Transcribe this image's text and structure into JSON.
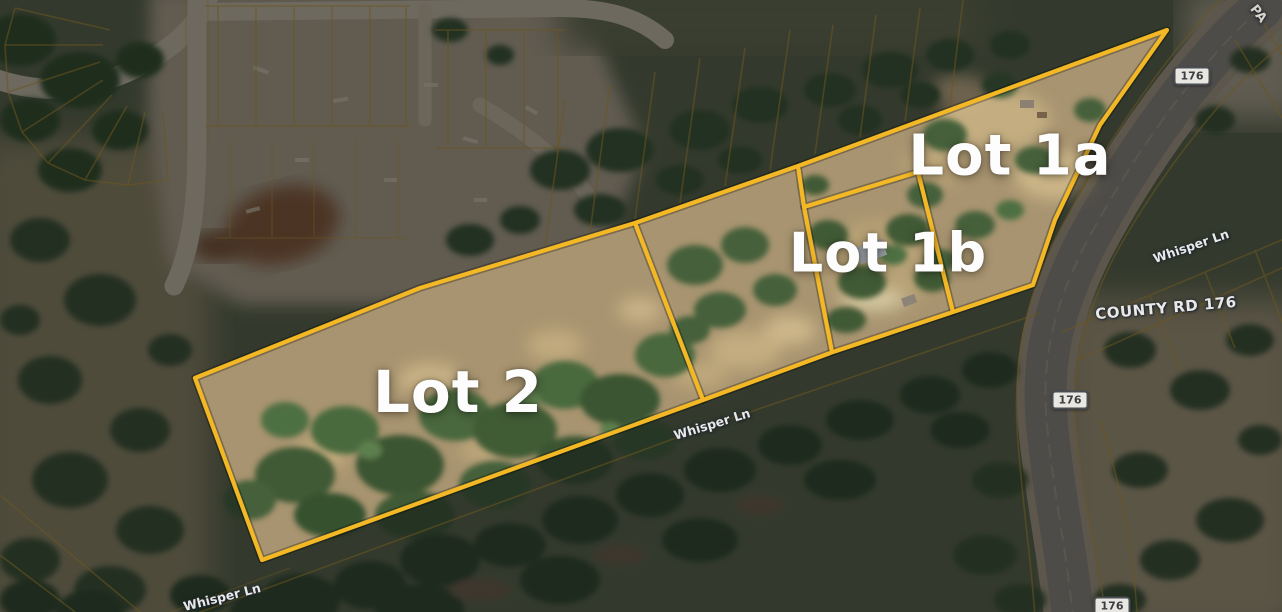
{
  "map": {
    "description": "Aerial parcel map with highlighted lots for sale",
    "lots": [
      {
        "id": "lot-1a",
        "label": "Lot 1a"
      },
      {
        "id": "lot-1b",
        "label": "Lot 1b"
      },
      {
        "id": "lot-2",
        "label": "Lot 2"
      }
    ],
    "roads": {
      "county_road": "COUNTY RD 176",
      "whisper_ln": "Whisper Ln",
      "route_badge": "176",
      "partial_road": "PA"
    },
    "colors": {
      "parcel_outline": "#F3B824",
      "dim_parcel_line": "#C79A2E",
      "label_text": "#FFFFFF",
      "badge_bg": "#E9E7E1",
      "badge_border": "#4A4E52",
      "badge_text": "#3A3E42",
      "dark_overlay": "rgba(6,9,14,0.47)"
    }
  }
}
